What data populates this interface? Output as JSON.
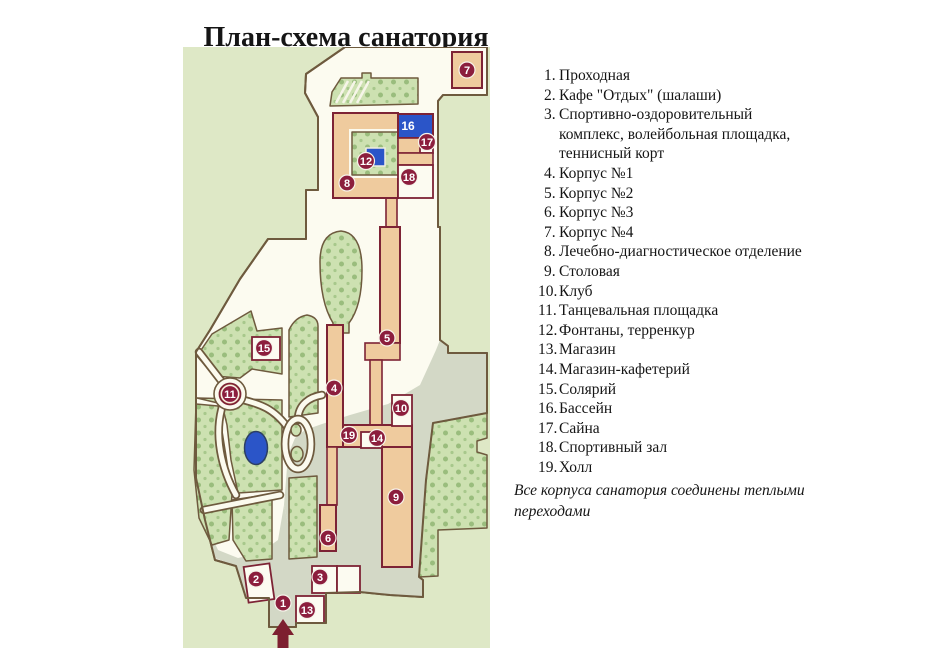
{
  "title": "План-схема санатория",
  "legend": {
    "items": [
      {
        "num": "1.",
        "label": "Проходная"
      },
      {
        "num": "2.",
        "label": "Кафе \"Отдых\" (шалаши)"
      },
      {
        "num": "3.",
        "lines": [
          "Спортивно-оздоровительный",
          "комплекс, волейбольная площадка,",
          "теннисный корт"
        ]
      },
      {
        "num": "4.",
        "label": "Корпус №1"
      },
      {
        "num": "5.",
        "label": "Корпус №2"
      },
      {
        "num": "6.",
        "label": "Корпус №3"
      },
      {
        "num": "7.",
        "label": "Корпус №4"
      },
      {
        "num": "8.",
        "label": "Лечебно-диагностическое отделение"
      },
      {
        "num": "9.",
        "label": "Столовая"
      },
      {
        "num": "10.",
        "label": "Клуб"
      },
      {
        "num": "11.",
        "label": "Танцевальная площадка"
      },
      {
        "num": "12.",
        "label": "Фонтаны, терренкур"
      },
      {
        "num": "13.",
        "label": "Магазин"
      },
      {
        "num": "14.",
        "label": "Магазин-кафетерий"
      },
      {
        "num": "15.",
        "label": "Солярий"
      },
      {
        "num": "16.",
        "label": "Бассейн"
      },
      {
        "num": "17.",
        "label": "Сайна"
      },
      {
        "num": "18.",
        "label": "Спортивный зал"
      },
      {
        "num": "19.",
        "label": "Холл"
      }
    ],
    "note_lines": [
      "Все корпуса санатория соединены теплыми",
      "переходами"
    ]
  },
  "map": {
    "markers": [
      {
        "label": "1"
      },
      {
        "label": "2"
      },
      {
        "label": "3"
      },
      {
        "label": "4"
      },
      {
        "label": "5"
      },
      {
        "label": "6"
      },
      {
        "label": "7"
      },
      {
        "label": "8"
      },
      {
        "label": "9"
      },
      {
        "label": "10"
      },
      {
        "label": "11"
      },
      {
        "label": "12"
      },
      {
        "label": "13"
      },
      {
        "label": "14"
      },
      {
        "label": "15"
      },
      {
        "label": "16"
      },
      {
        "label": "17"
      },
      {
        "label": "18"
      },
      {
        "label": "19"
      }
    ],
    "colors": {
      "background": "#dee8c6",
      "grounds": "#fcfbf0",
      "paved": "#d3d8c6",
      "park": "#cde1b1",
      "park_dot": "#9abd7d",
      "building_tan": "#efcb9e",
      "building_outline": "#7d2335",
      "water": "#2b55c8",
      "marker": "#8c1e3d",
      "outline": "#6e5a3e",
      "arrow": "#7d1f30"
    }
  }
}
